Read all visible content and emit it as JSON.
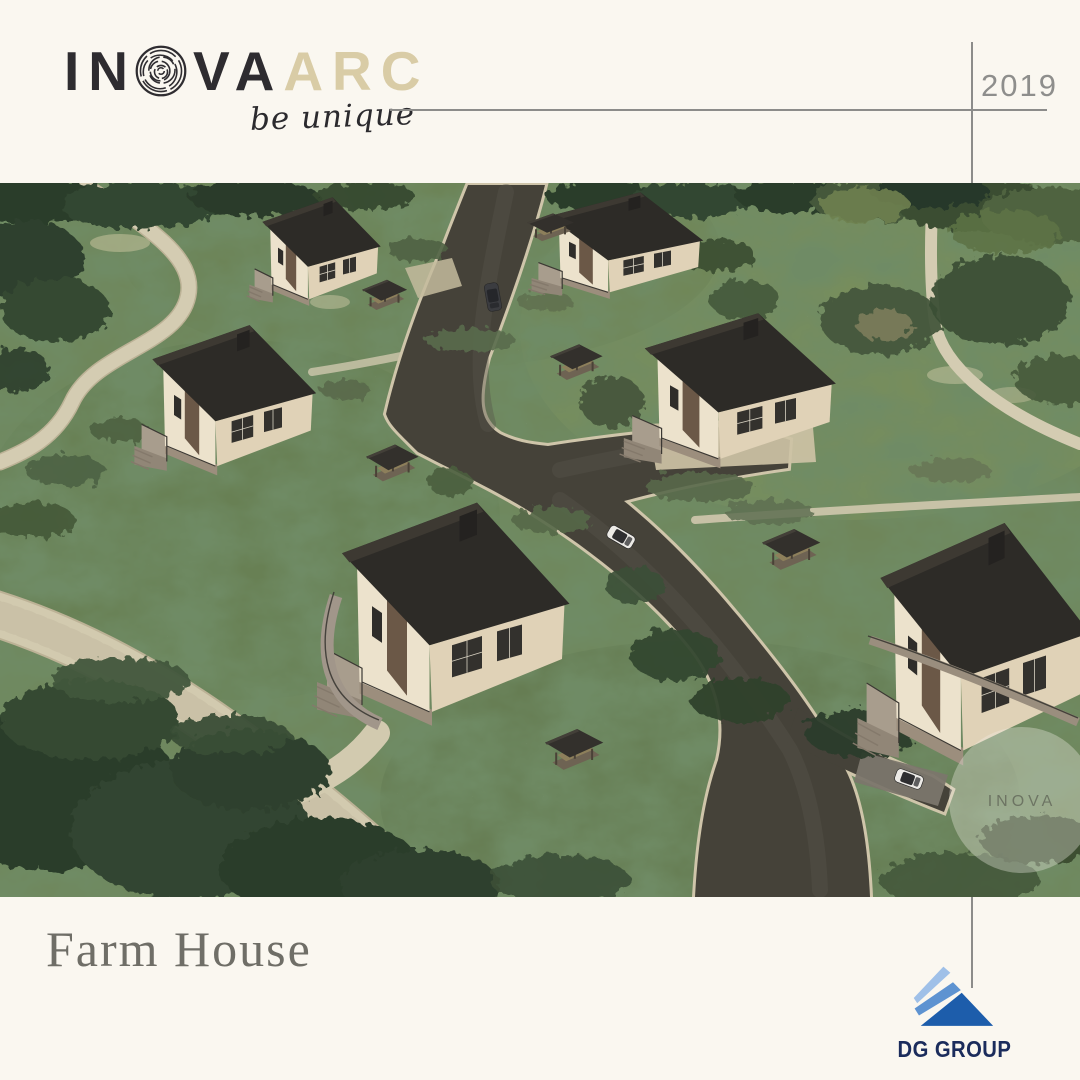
{
  "brand": {
    "wordmark_in": "IN",
    "wordmark_va": "VA",
    "wordmark_arc": "ARC",
    "tagline": "be unique"
  },
  "year": "2019",
  "title": "Farm House",
  "partner_logo": {
    "text": "DG GROUP"
  },
  "watermark": {
    "text": "INOVA"
  },
  "colors": {
    "background": "#faf7f0",
    "wordmark_dark": "#2e2c30",
    "wordmark_accent": "#d9cca6",
    "rule_gray": "#8c8c8a",
    "title_gray": "#6f6e67",
    "dg_navy": "#1b2c5c",
    "dg_blue_dark": "#1d5dab",
    "dg_blue_mid": "#5e93d1",
    "dg_blue_light": "#9fc0e8",
    "roof_charcoal": "#2d2b27",
    "wall_cream": "#ece2cc",
    "asphalt": "#454239",
    "curb_beige": "#cfc5aa",
    "grass_green": "#6f865a"
  }
}
